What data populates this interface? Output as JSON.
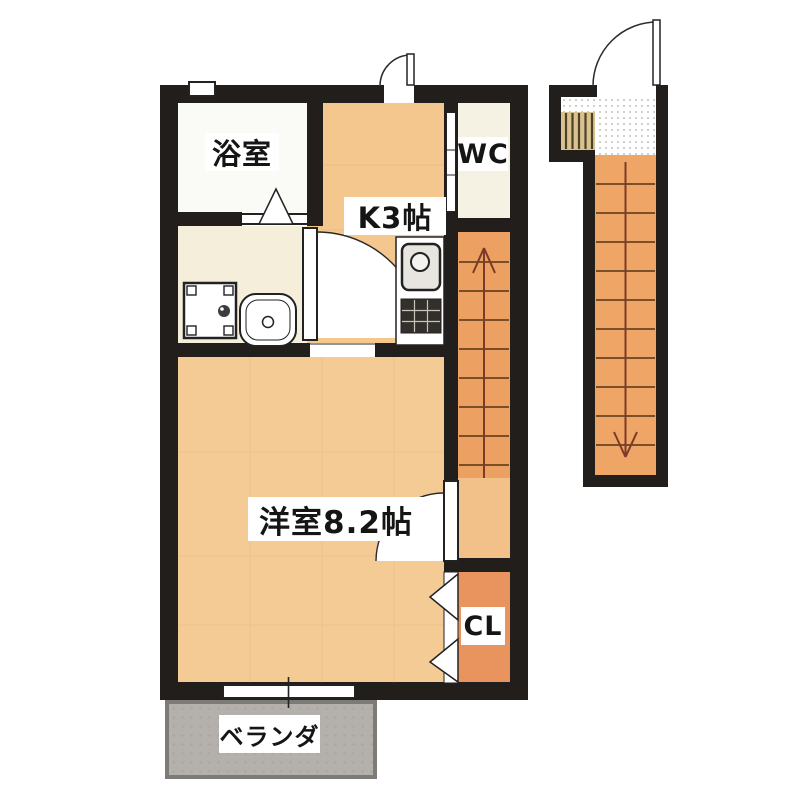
{
  "plan": {
    "type": "apartment-floor-plan",
    "labels": {
      "bathroom": "浴室",
      "kitchen": "K3帖",
      "toilet": "WC",
      "room": "洋室8.2帖",
      "closet": "CL",
      "veranda": "ベランダ"
    },
    "stairs": {
      "internal_arrow": "up",
      "external_arrow": "down"
    },
    "colors": {
      "wall": "#211e1b",
      "bathroom_floor": "#fafaf6",
      "washroom_floor": "#f4eedb",
      "kitchen_floor": "#f3c78d",
      "wc_floor": "#f5f1e3",
      "room_floor": "#f5cb95",
      "stairs_floor": "#eca061",
      "landing_floor": "#f2c18a",
      "closet_floor": "#e9945e",
      "ext_stairs_floor": "#efa566",
      "step_stripe": "#d9c28f",
      "veranda_floor": "#b4b1ad",
      "veranda_border": "#7d7b77",
      "stair_line": "#553415",
      "arrow": "#7b3b28"
    }
  }
}
